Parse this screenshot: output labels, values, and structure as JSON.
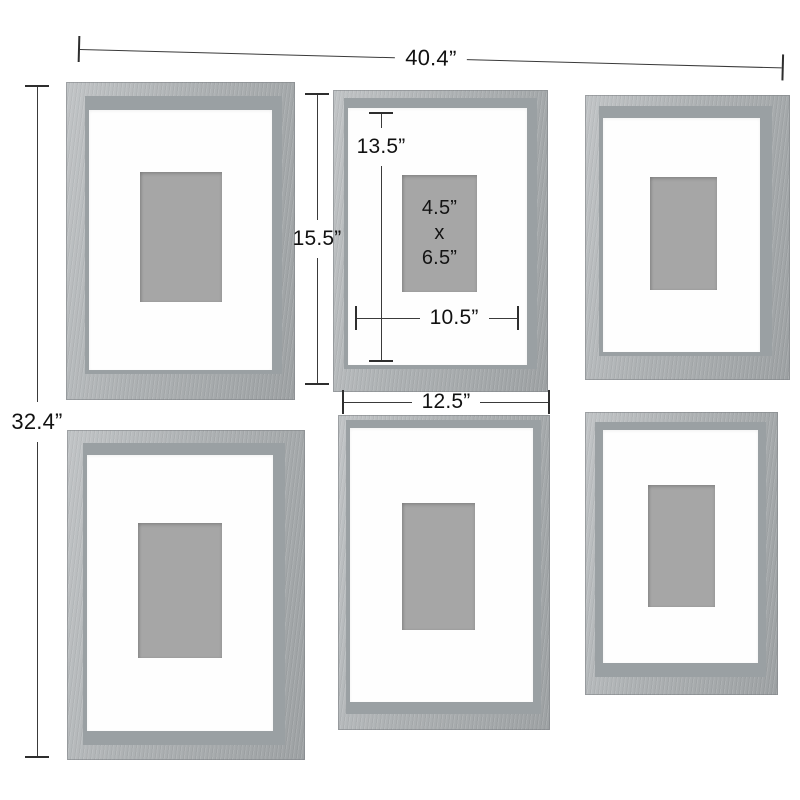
{
  "figure": {
    "kind": "product-dimension-diagram",
    "subject": "6-piece gallery wall picture frame set, grey wood shadow-box frames with white mats"
  },
  "colors": {
    "background": "#ffffff",
    "frame_wood_light": "#c1c4c6",
    "frame_wood_mid": "#adb1b3",
    "frame_inner_face": "#9aa0a3",
    "mat": "#fefefe",
    "photo_placeholder": "#a6a6a6",
    "dimension_line": "#3a3a3a",
    "dimension_text": "#111111"
  },
  "dimension_labels": {
    "overall_width": "40.4”",
    "overall_height": "32.4”",
    "frame_outer_height": "15.5”",
    "mat_opening_height": "13.5”",
    "photo_width": "4.5”",
    "photo_separator": "x",
    "photo_height": "6.5”",
    "mat_opening_width": "10.5”",
    "frame_outer_width": "12.5”"
  },
  "frames": [
    {
      "position": "top-left"
    },
    {
      "position": "top-middle",
      "has_size_annotations": true
    },
    {
      "position": "top-right"
    },
    {
      "position": "bottom-left"
    },
    {
      "position": "bottom-middle"
    },
    {
      "position": "bottom-right"
    }
  ],
  "grid": {
    "rows": 2,
    "columns": 3
  }
}
